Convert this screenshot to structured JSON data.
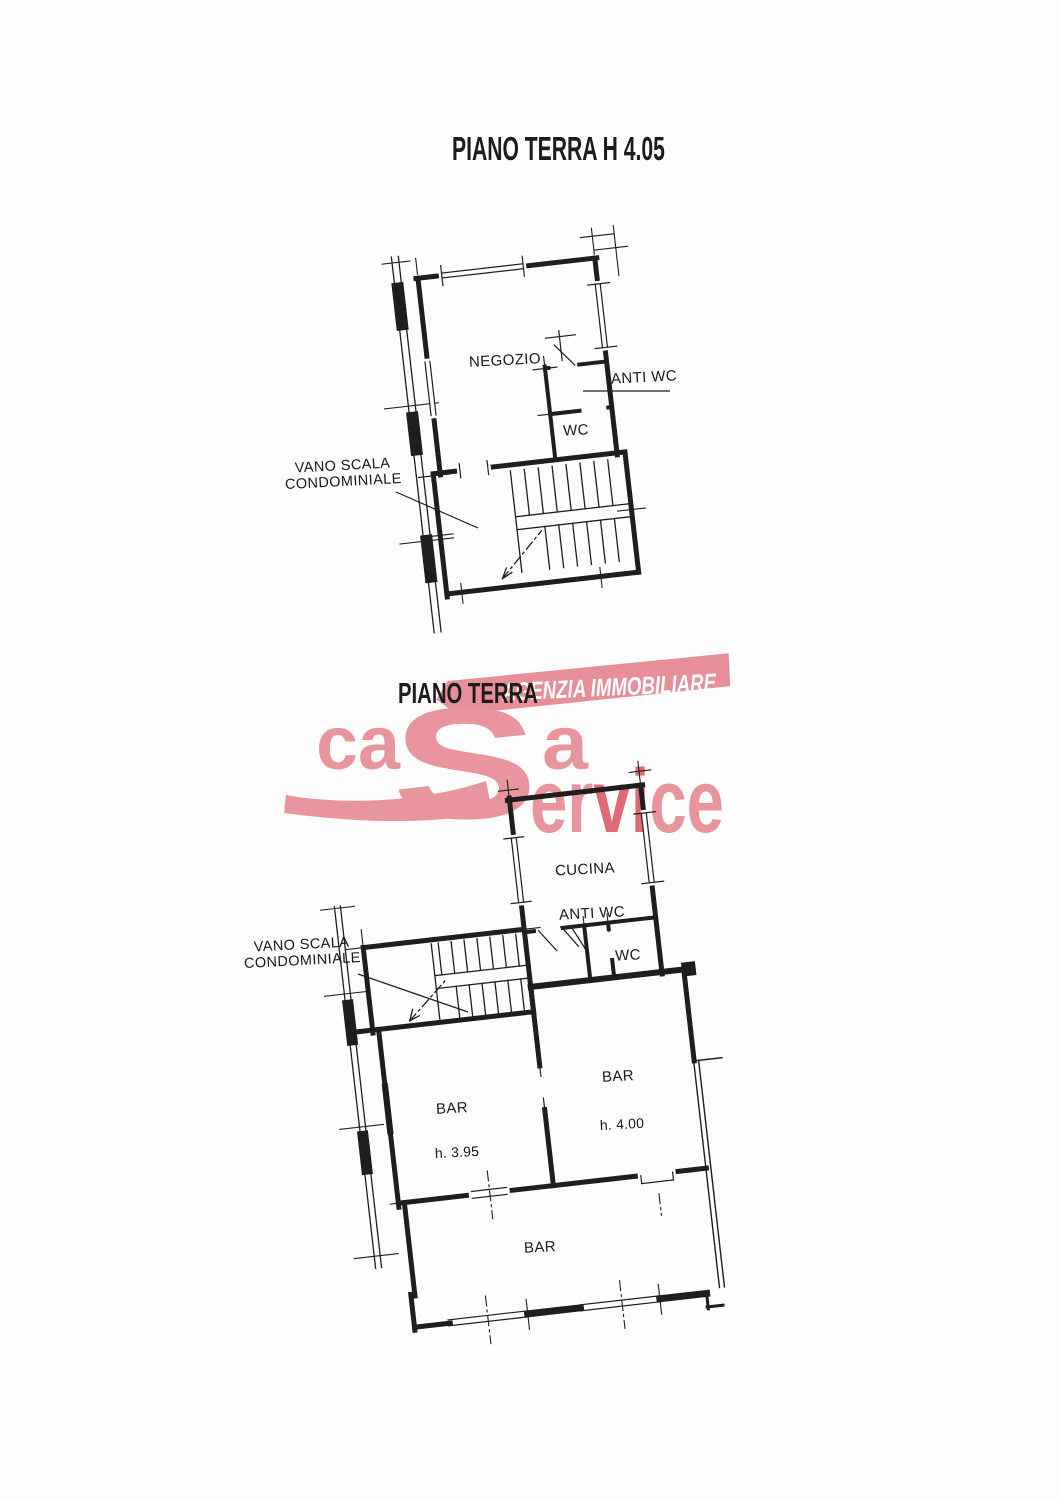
{
  "page": {
    "background": "#fdfdfd",
    "ink": "#1e1e1e"
  },
  "upper_plan": {
    "title": "PIANO TERRA H 4.05",
    "labels": {
      "negozio": "NEGOZIO",
      "anti_wc": "ANTI WC",
      "wc": "WC",
      "stairwell_line1": "VANO SCALA",
      "stairwell_line2": "CONDOMINIALE"
    }
  },
  "lower_plan": {
    "title": "PIANO TERRA",
    "labels": {
      "cucina": "CUCINA",
      "anti_wc": "ANTI WC",
      "wc": "WC",
      "stairwell_line1": "VANO SCALA",
      "stairwell_line2": "CONDOMINIALE",
      "bar_left": "BAR",
      "bar_left_h": "h. 3.95",
      "bar_right": "BAR",
      "bar_right_h": "h. 4.00",
      "bar_bottom": "BAR"
    }
  },
  "logo": {
    "banner_text": "AGENZIA IMMOBILIARE",
    "word_start": "ca",
    "word_s": "S",
    "word_a": "a",
    "word_end_parts": {
      "p1": "er",
      "p2": "vi",
      "p3": "ce"
    },
    "colors": {
      "pink": "#e8959e",
      "accent": "#dd6a75",
      "banner": "#e78f99",
      "banner_text": "#ffffff"
    }
  }
}
